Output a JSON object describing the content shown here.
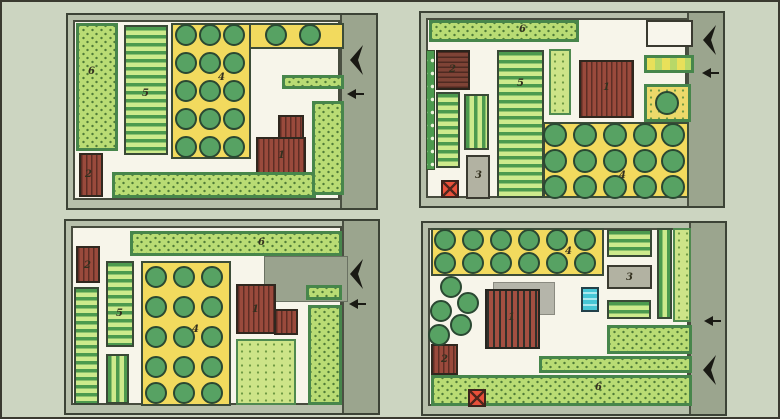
{
  "palette": {
    "page_bg": "#ccd5c1",
    "plan_margin": "#b7c0ab",
    "road": "#9ba58e",
    "interior": "#f7f5ea",
    "lawn_green": "#b9dc74",
    "lawn_border": "#47864b",
    "bed_dark": "#4c9a4e",
    "bed_light": "#cdea8c",
    "orchard_yellow": "#f2da5e",
    "tree_green": "#57a263",
    "building_brown": "#9a4a3c",
    "patio_gray": "#b2b2a2",
    "pool_blue": "#46c6d6",
    "marker_red": "#e8503a",
    "ink": "#1a1a14"
  },
  "legend_numbers": [
    "1",
    "2",
    "3",
    "4",
    "5",
    "6"
  ],
  "plans": [
    {
      "name": "garden-plan-top-left",
      "box": {
        "left": 64,
        "top": 11,
        "width": 312,
        "height": 197
      },
      "areas": [
        {
          "name": "lawn-left",
          "type": "lawn",
          "label": "6",
          "x": 8,
          "y": 8,
          "w": 42,
          "h": 128,
          "lx": 20,
          "ly": 52
        },
        {
          "name": "shed",
          "type": "building",
          "label": "2",
          "x": 11,
          "y": 138,
          "w": 24,
          "h": 44,
          "lx": 17,
          "ly": 155
        },
        {
          "name": "vegetable-beds",
          "type": "beds-h",
          "label": "5",
          "x": 56,
          "y": 10,
          "w": 44,
          "h": 130,
          "lx": 74,
          "ly": 74
        },
        {
          "name": "orchard-main",
          "type": "orchard",
          "label": "4",
          "x": 103,
          "y": 8,
          "w": 80,
          "h": 136,
          "lx": 150,
          "ly": 58
        },
        {
          "name": "orchard-ext",
          "type": "orchard",
          "x": 181,
          "y": 8,
          "w": 95,
          "h": 26
        },
        {
          "name": "lawn-strip-small",
          "type": "lawn",
          "x": 214,
          "y": 60,
          "w": 62,
          "h": 14
        },
        {
          "name": "house-wing",
          "type": "building",
          "x": 210,
          "y": 100,
          "w": 26,
          "h": 24
        },
        {
          "name": "house",
          "type": "building",
          "label": "1",
          "x": 188,
          "y": 122,
          "w": 50,
          "h": 40,
          "lx": 210,
          "ly": 136
        },
        {
          "name": "lawn-bottom",
          "type": "lawn",
          "x": 44,
          "y": 157,
          "w": 204,
          "h": 26
        },
        {
          "name": "lawn-right",
          "type": "lawn",
          "x": 244,
          "y": 86,
          "w": 32,
          "h": 94
        }
      ],
      "trees": {
        "r": 11,
        "pts": [
          [
            118,
            20
          ],
          [
            142,
            20
          ],
          [
            166,
            20
          ],
          [
            208,
            20
          ],
          [
            242,
            20
          ],
          [
            118,
            48
          ],
          [
            142,
            48
          ],
          [
            166,
            48
          ],
          [
            118,
            76
          ],
          [
            142,
            76
          ],
          [
            166,
            76
          ],
          [
            118,
            104
          ],
          [
            142,
            104
          ],
          [
            166,
            104
          ],
          [
            118,
            132
          ],
          [
            142,
            132
          ],
          [
            166,
            132
          ]
        ]
      },
      "arrows": [
        {
          "kind": "big",
          "x": 282,
          "y": 30
        },
        {
          "kind": "small",
          "x": 279,
          "y": 74
        }
      ]
    },
    {
      "name": "garden-plan-top-right",
      "box": {
        "left": 417,
        "top": 9,
        "width": 306,
        "height": 197
      },
      "areas": [
        {
          "name": "lawn-top",
          "type": "lawn",
          "label": "6",
          "x": 8,
          "y": 7,
          "w": 150,
          "h": 22,
          "lx": 98,
          "ly": 12
        },
        {
          "name": "paved-pad",
          "type": "white",
          "x": 225,
          "y": 7,
          "w": 47,
          "h": 27
        },
        {
          "name": "flower-strip",
          "type": "flower",
          "x": 223,
          "y": 42,
          "w": 50,
          "h": 18
        },
        {
          "name": "shrub-strip",
          "type": "shrub",
          "x": 5,
          "y": 37,
          "w": 9,
          "h": 120
        },
        {
          "name": "shed",
          "type": "building-dark",
          "label": "2",
          "x": 15,
          "y": 37,
          "w": 34,
          "h": 40,
          "lx": 28,
          "ly": 52
        },
        {
          "name": "beds-left",
          "type": "beds-h",
          "x": 15,
          "y": 79,
          "w": 24,
          "h": 76
        },
        {
          "name": "beds-small",
          "type": "beds-v",
          "x": 43,
          "y": 81,
          "w": 25,
          "h": 56
        },
        {
          "name": "patio",
          "type": "gray",
          "label": "3",
          "x": 45,
          "y": 142,
          "w": 24,
          "h": 44,
          "lx": 54,
          "ly": 158
        },
        {
          "name": "red-x-marker",
          "type": "redx",
          "x": 20,
          "y": 167,
          "w": 18,
          "h": 18
        },
        {
          "name": "vegetable-beds",
          "type": "beds-h",
          "label": "5",
          "x": 76,
          "y": 37,
          "w": 47,
          "h": 148,
          "lx": 96,
          "ly": 66
        },
        {
          "name": "lawn-col-small",
          "type": "lawn-light",
          "x": 128,
          "y": 36,
          "w": 22,
          "h": 66
        },
        {
          "name": "house",
          "type": "building",
          "label": "1",
          "x": 158,
          "y": 47,
          "w": 55,
          "h": 58,
          "lx": 182,
          "ly": 70
        },
        {
          "name": "orchard-corner",
          "type": "orchard-ext",
          "x": 223,
          "y": 71,
          "w": 47,
          "h": 38
        },
        {
          "name": "orchard",
          "type": "orchard",
          "label": "4",
          "x": 122,
          "y": 109,
          "w": 146,
          "h": 76,
          "lx": 198,
          "ly": 158
        }
      ],
      "trees": {
        "r": 12,
        "pts": [
          [
            134,
            122
          ],
          [
            164,
            122
          ],
          [
            194,
            122
          ],
          [
            224,
            122
          ],
          [
            252,
            122
          ],
          [
            134,
            148
          ],
          [
            164,
            148
          ],
          [
            194,
            148
          ],
          [
            224,
            148
          ],
          [
            252,
            148
          ],
          [
            134,
            174
          ],
          [
            164,
            174
          ],
          [
            194,
            174
          ],
          [
            224,
            174
          ],
          [
            252,
            174
          ],
          [
            246,
            90
          ]
        ]
      },
      "arrows": [
        {
          "kind": "big",
          "x": 282,
          "y": 12
        },
        {
          "kind": "small",
          "x": 281,
          "y": 55
        }
      ]
    },
    {
      "name": "garden-plan-bottom-left",
      "box": {
        "left": 62,
        "top": 217,
        "width": 316,
        "height": 196
      },
      "areas": [
        {
          "name": "lawn-top",
          "type": "lawn",
          "label": "6",
          "x": 64,
          "y": 10,
          "w": 212,
          "h": 25,
          "lx": 192,
          "ly": 17
        },
        {
          "name": "shed",
          "type": "building",
          "label": "2",
          "x": 10,
          "y": 25,
          "w": 24,
          "h": 37,
          "lx": 18,
          "ly": 40
        },
        {
          "name": "beds-left",
          "type": "beds-h",
          "x": 8,
          "y": 66,
          "w": 25,
          "h": 118
        },
        {
          "name": "vegetable-beds",
          "type": "beds-h",
          "label": "5",
          "x": 40,
          "y": 40,
          "w": 28,
          "h": 86,
          "lx": 50,
          "ly": 88
        },
        {
          "name": "beds-small",
          "type": "beds-v",
          "x": 40,
          "y": 133,
          "w": 23,
          "h": 50
        },
        {
          "name": "orchard",
          "type": "orchard",
          "label": "4",
          "x": 75,
          "y": 40,
          "w": 90,
          "h": 145,
          "lx": 126,
          "ly": 104
        },
        {
          "name": "entrance-yard",
          "type": "yard",
          "x": 198,
          "y": 35,
          "w": 84,
          "h": 46
        },
        {
          "name": "lawn-strip-small",
          "type": "lawn",
          "x": 240,
          "y": 64,
          "w": 36,
          "h": 15
        },
        {
          "name": "house",
          "type": "building",
          "label": "1",
          "x": 170,
          "y": 63,
          "w": 40,
          "h": 50,
          "lx": 186,
          "ly": 84
        },
        {
          "name": "house-wing",
          "type": "building",
          "x": 208,
          "y": 88,
          "w": 24,
          "h": 26
        },
        {
          "name": "lawn-right",
          "type": "lawn",
          "x": 242,
          "y": 84,
          "w": 34,
          "h": 100
        },
        {
          "name": "lawn-square",
          "type": "lawn-light",
          "x": 170,
          "y": 118,
          "w": 60,
          "h": 66
        }
      ],
      "trees": {
        "r": 11,
        "pts": [
          [
            90,
            56
          ],
          [
            118,
            56
          ],
          [
            146,
            56
          ],
          [
            90,
            86
          ],
          [
            118,
            86
          ],
          [
            146,
            86
          ],
          [
            90,
            116
          ],
          [
            118,
            116
          ],
          [
            146,
            116
          ],
          [
            90,
            146
          ],
          [
            118,
            146
          ],
          [
            146,
            146
          ],
          [
            90,
            172
          ],
          [
            118,
            172
          ],
          [
            146,
            172
          ]
        ]
      },
      "arrows": [
        {
          "kind": "big",
          "x": 284,
          "y": 38
        },
        {
          "kind": "small",
          "x": 283,
          "y": 78
        }
      ]
    },
    {
      "name": "garden-plan-bottom-right",
      "box": {
        "left": 419,
        "top": 219,
        "width": 306,
        "height": 195
      },
      "areas": [
        {
          "name": "orchard",
          "type": "orchard",
          "label": "4",
          "x": 8,
          "y": 5,
          "w": 173,
          "h": 48,
          "lx": 142,
          "ly": 24
        },
        {
          "name": "beds-topright",
          "type": "beds-h",
          "x": 184,
          "y": 6,
          "w": 45,
          "h": 28
        },
        {
          "name": "patio",
          "type": "gray",
          "label": "3",
          "x": 184,
          "y": 42,
          "w": 45,
          "h": 24,
          "lx": 203,
          "ly": 50
        },
        {
          "name": "beds-midright",
          "type": "beds-h",
          "x": 184,
          "y": 77,
          "w": 44,
          "h": 19
        },
        {
          "name": "beds-col",
          "type": "beds-v",
          "x": 234,
          "y": 5,
          "w": 15,
          "h": 91
        },
        {
          "name": "lawn-col",
          "type": "lawn-light",
          "x": 250,
          "y": 5,
          "w": 18,
          "h": 94
        },
        {
          "name": "house-shadow",
          "type": "shadow",
          "x": 70,
          "y": 59,
          "w": 62,
          "h": 33
        },
        {
          "name": "house",
          "type": "house-striped",
          "label": "1",
          "x": 62,
          "y": 66,
          "w": 55,
          "h": 60,
          "lx": 85,
          "ly": 90
        },
        {
          "name": "pool",
          "type": "pool",
          "x": 158,
          "y": 64,
          "w": 18,
          "h": 25
        },
        {
          "name": "lawn-right",
          "type": "lawn",
          "x": 184,
          "y": 102,
          "w": 85,
          "h": 29
        },
        {
          "name": "lawn-mid",
          "type": "lawn",
          "x": 116,
          "y": 133,
          "w": 153,
          "h": 17
        },
        {
          "name": "lawn-bottom",
          "type": "lawn",
          "label": "6",
          "x": 8,
          "y": 152,
          "w": 261,
          "h": 31,
          "lx": 172,
          "ly": 160
        },
        {
          "name": "shed",
          "type": "building",
          "label": "2",
          "x": 8,
          "y": 121,
          "w": 27,
          "h": 31,
          "lx": 18,
          "ly": 132
        },
        {
          "name": "red-x-marker",
          "type": "redx",
          "x": 45,
          "y": 166,
          "w": 18,
          "h": 18
        }
      ],
      "trees": {
        "r": 11,
        "pts": [
          [
            22,
            17
          ],
          [
            50,
            17
          ],
          [
            78,
            17
          ],
          [
            106,
            17
          ],
          [
            134,
            17
          ],
          [
            162,
            17
          ],
          [
            22,
            40
          ],
          [
            50,
            40
          ],
          [
            78,
            40
          ],
          [
            106,
            40
          ],
          [
            134,
            40
          ],
          [
            162,
            40
          ],
          [
            28,
            64
          ],
          [
            45,
            80
          ],
          [
            18,
            88
          ],
          [
            38,
            102
          ],
          [
            16,
            112
          ]
        ]
      },
      "arrows": [
        {
          "kind": "small",
          "x": 281,
          "y": 93
        },
        {
          "kind": "big",
          "x": 280,
          "y": 132
        }
      ]
    }
  ]
}
